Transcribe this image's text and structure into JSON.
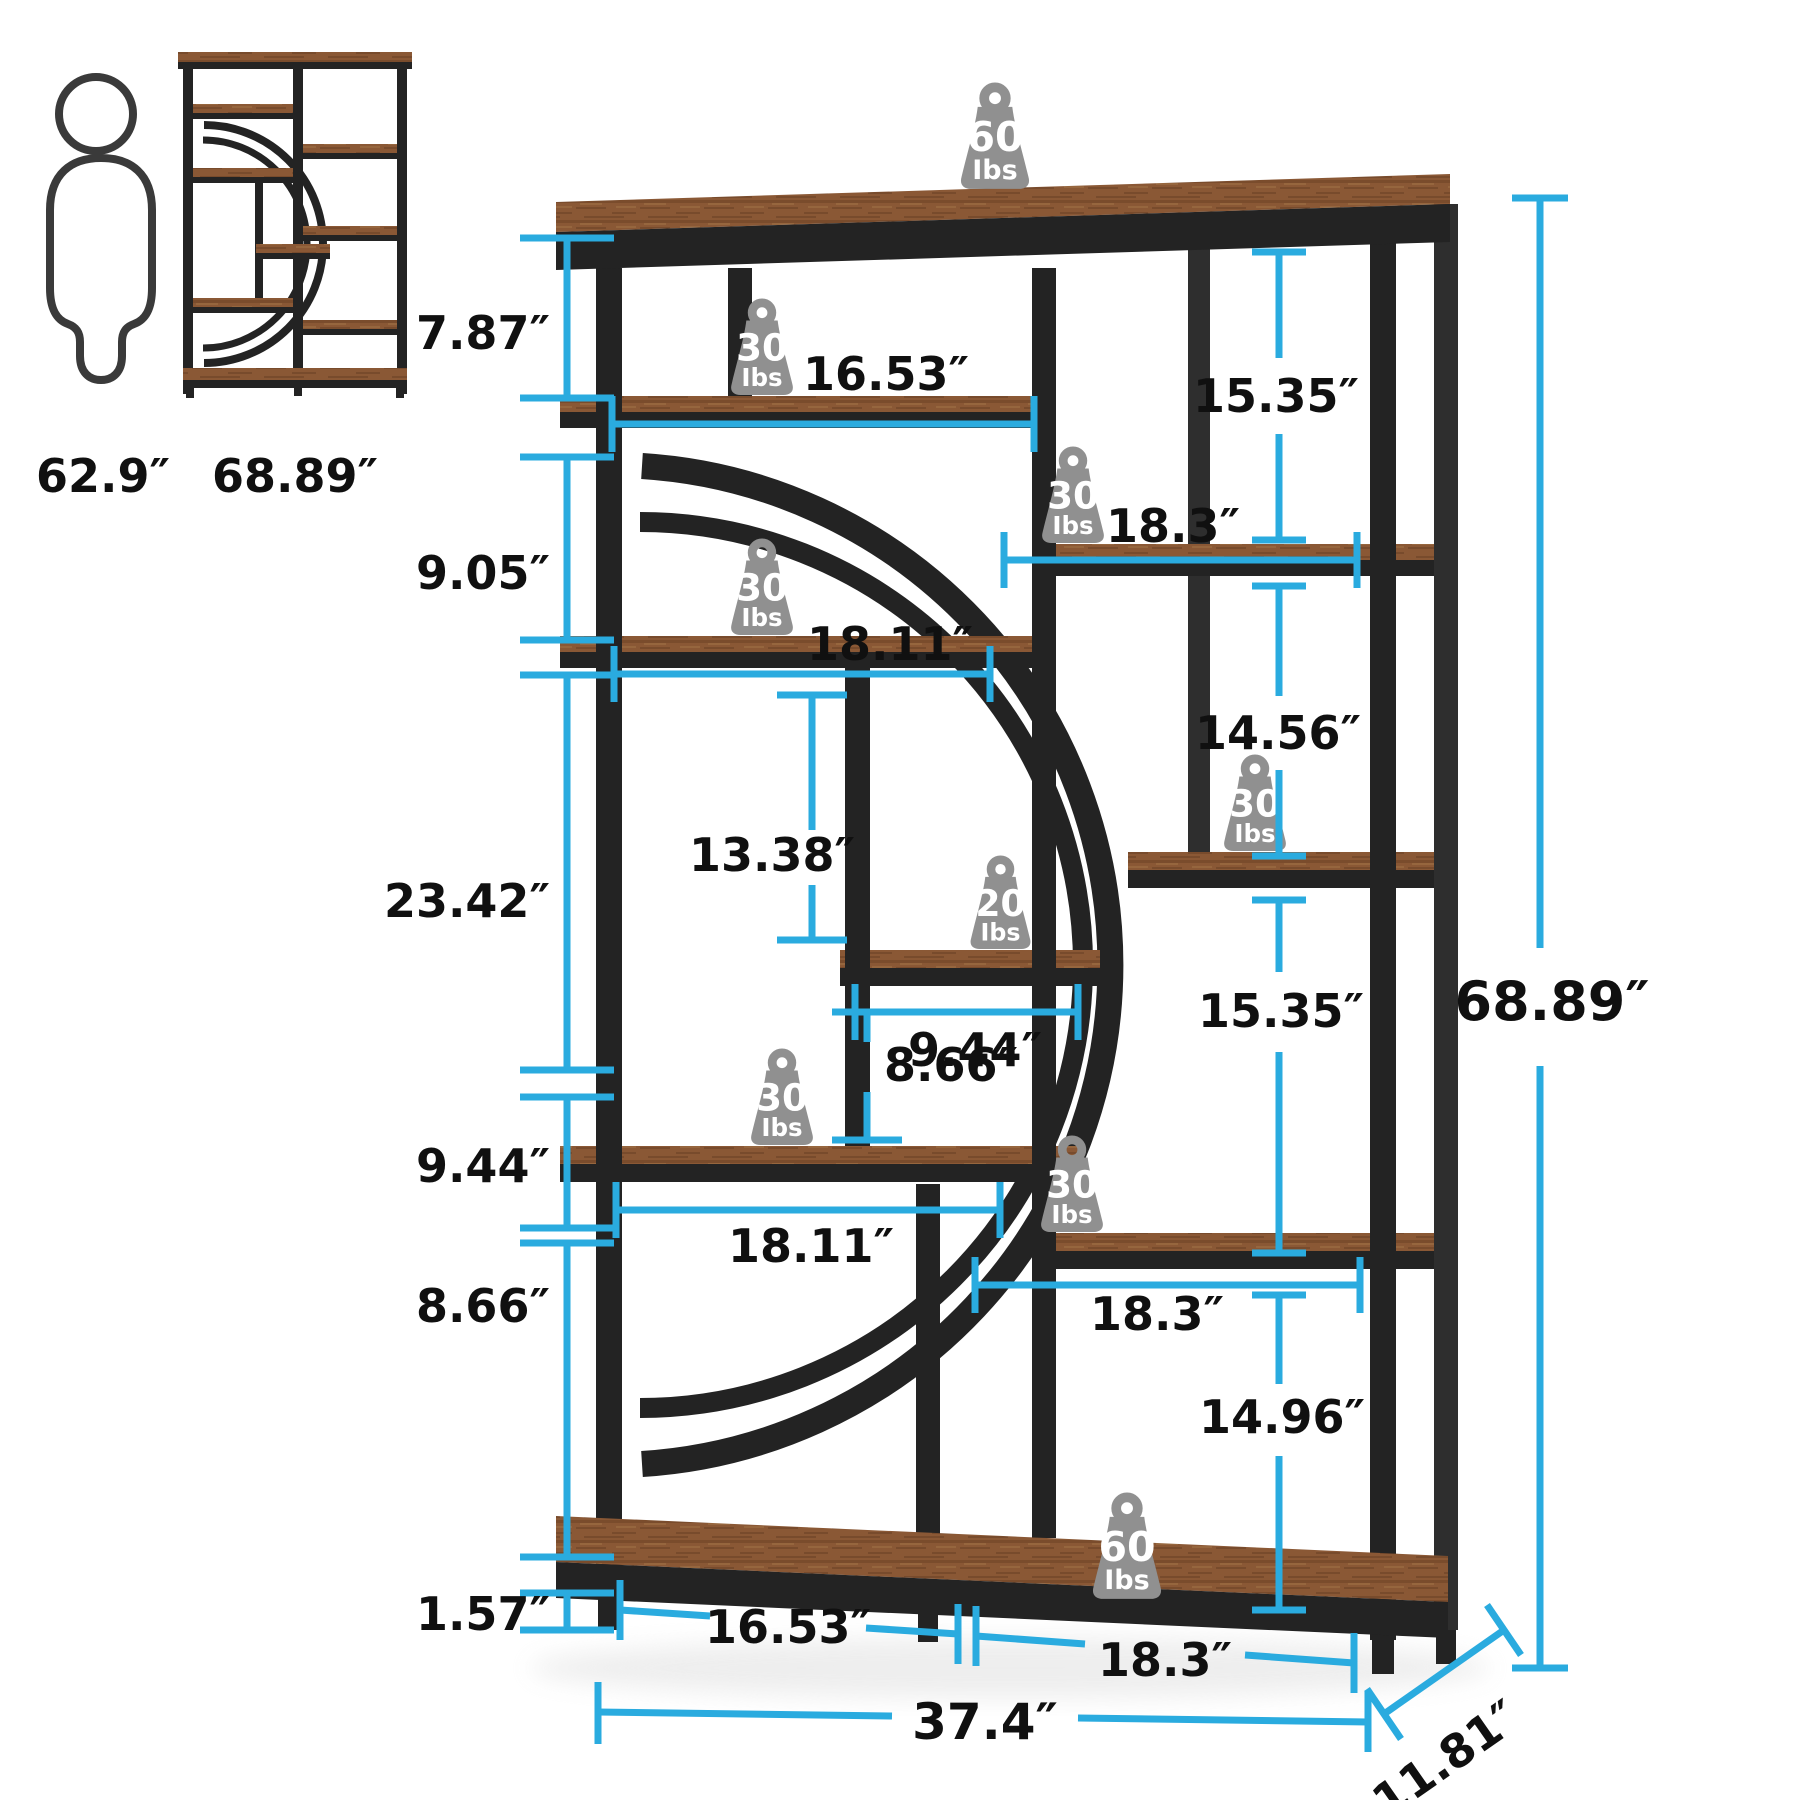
{
  "scale_reference": {
    "person_height": "62.9″",
    "bookcase_height": "68.89″"
  },
  "dimensions": {
    "left": [
      "7.87″",
      "9.05″",
      "23.42″",
      "9.44″",
      "8.66″",
      "1.57″"
    ],
    "inner_right": [
      "15.35″",
      "14.56″",
      "15.35″",
      "14.96″"
    ],
    "overall_height": "68.89″",
    "shelf_widths": {
      "tier2": "16.53″",
      "tier3": "18.3″",
      "tier4": "18.11″",
      "tier5": "9.44″",
      "tier7": "18.11″",
      "tier8": "18.3″"
    },
    "middle_vertical": [
      "13.38″",
      "8.66″"
    ],
    "bottom": {
      "left_section": "16.53″",
      "right_section": "18.3″",
      "overall_width": "37.4″",
      "depth": "11.81″"
    }
  },
  "weights": [
    {
      "value": "60",
      "unit": "Ibs"
    },
    {
      "value": "30",
      "unit": "Ibs"
    },
    {
      "value": "30",
      "unit": "Ibs"
    },
    {
      "value": "30",
      "unit": "Ibs"
    },
    {
      "value": "20",
      "unit": "Ibs"
    },
    {
      "value": "30",
      "unit": "Ibs"
    },
    {
      "value": "30",
      "unit": "Ibs"
    },
    {
      "value": "30",
      "unit": "Ibs"
    },
    {
      "value": "60",
      "unit": "Ibs"
    }
  ],
  "colors": {
    "dimension_line": "#2aabdf",
    "metal_frame": "#232323",
    "wood": "#8a5835",
    "weight_icon": "#909090",
    "label_text": "#101010"
  }
}
